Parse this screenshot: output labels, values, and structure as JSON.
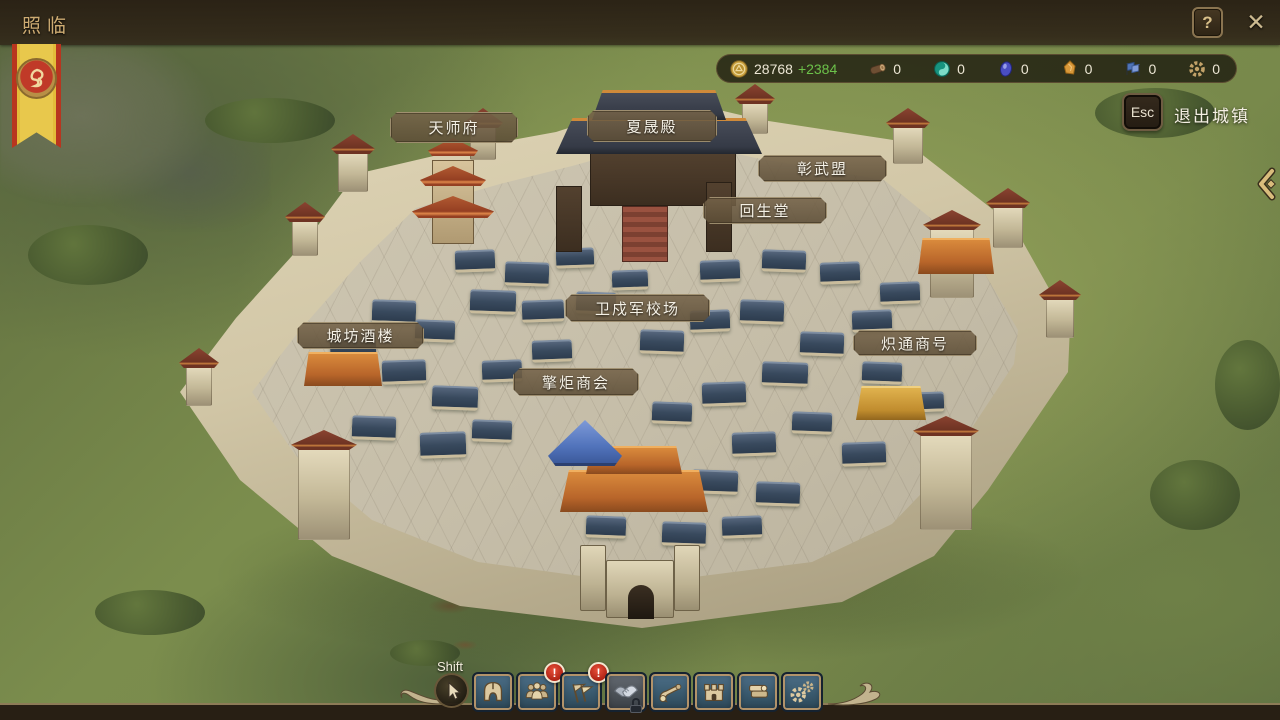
{
  "window": {
    "title": "照临",
    "help": "?",
    "close": "✕"
  },
  "resource_bar": {
    "gold": {
      "value": "28768",
      "delta": "+2384"
    },
    "resources": [
      {
        "name": "wood",
        "value": "0"
      },
      {
        "name": "jade",
        "value": "0"
      },
      {
        "name": "ore",
        "value": "0"
      },
      {
        "name": "amber",
        "value": "0"
      },
      {
        "name": "banners",
        "value": "0"
      },
      {
        "name": "parts",
        "value": "0"
      }
    ]
  },
  "exit_button": {
    "key": "Esc",
    "label": "退出城镇"
  },
  "building_labels": [
    {
      "name": "天师府"
    },
    {
      "name": "夏晟殿"
    },
    {
      "name": "彰武盟"
    },
    {
      "name": "回生堂"
    },
    {
      "name": "卫戍军校场"
    },
    {
      "name": "城坊酒楼"
    },
    {
      "name": "擎炬商会"
    },
    {
      "name": "炽通商号"
    }
  ],
  "toolbar": {
    "modifier_hint": "Shift",
    "buttons": [
      {
        "name": "hero",
        "badge": ""
      },
      {
        "name": "population",
        "badge": "!"
      },
      {
        "name": "flags",
        "badge": "!"
      },
      {
        "name": "diplomacy",
        "badge": "",
        "locked": true
      },
      {
        "name": "scroll",
        "badge": ""
      },
      {
        "name": "city",
        "badge": ""
      },
      {
        "name": "ledger",
        "badge": ""
      },
      {
        "name": "settings",
        "badge": ""
      }
    ]
  },
  "colors": {
    "gold_delta": "#6cc24a",
    "badge_red": "#cf3524",
    "accent_gold": "#d9bc7c"
  }
}
